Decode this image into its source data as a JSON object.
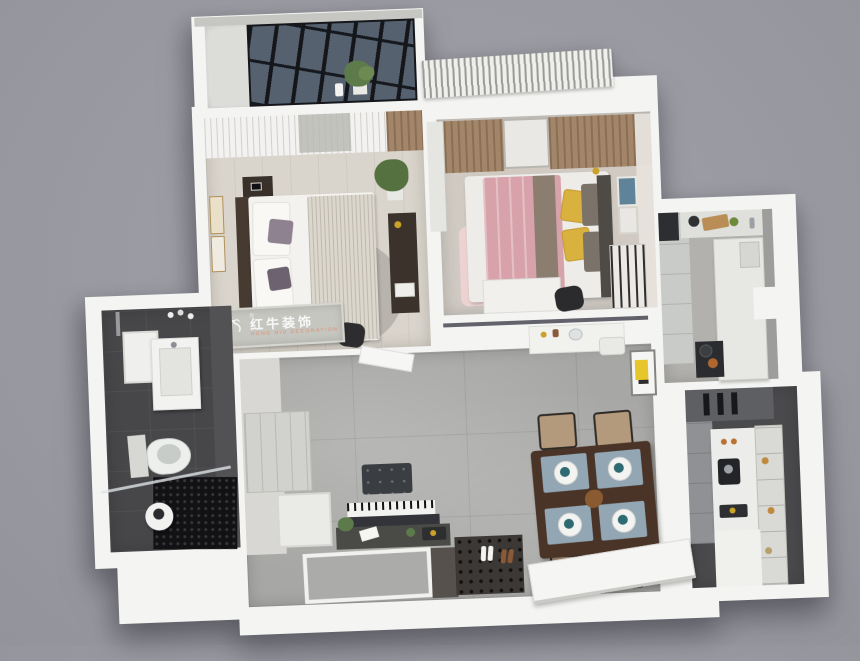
{
  "meta": {
    "description": "3D top-down isometric rendering of a two-bedroom apartment floor plan",
    "background_color": "#9a9aa2",
    "wall_color": "#f4f4f2"
  },
  "watermark": {
    "logo": "bull-icon",
    "registered": "®",
    "brand_cn": "红牛装饰",
    "brand_en": "HONG NIU DECORATION",
    "panel_color": "#c6c6c0",
    "cn_text_color": "#ffffff",
    "en_text_color": "#e9805c"
  },
  "palette": {
    "living_floor_marble": "#a7a7a5",
    "bedroom1_floor": "#dad5cc",
    "bedroom2_floor": "#d0cac3",
    "bathroom_tile": "#47474a",
    "shower_mosaic": "#121214",
    "kitchen_floor": "#b3b1ad",
    "glass_window": "#566170",
    "pink_duvet": "#d8a2aa",
    "yellow_pillow": "#d9b13e",
    "accent_pillow": "#8e8290",
    "dark_wood": "#4a3427",
    "chair_seat": "#b49a7d",
    "placemat": "#92a6b4",
    "napkin_teal": "#2e6a72",
    "plant_green": "#5d7a4a",
    "gold": "#c9a227"
  },
  "rooms": [
    {
      "id": "balcony",
      "name": "balcony",
      "features": [
        "black-framed glass skylight windows",
        "wardrobe cabinet",
        "potted plant",
        "white vase"
      ]
    },
    {
      "id": "master-bedroom",
      "name": "master bedroom",
      "features": [
        "white double bed with ribbed blanket",
        "dark headboard",
        "sheer curtains",
        "nightstand with phone",
        "desk with books",
        "round rug",
        "potted plant",
        "two wall frames",
        "office chair",
        "watermark banner"
      ]
    },
    {
      "id": "second-bedroom",
      "name": "second bedroom",
      "features": [
        "pink double bed",
        "two yellow pillows",
        "gray pillows",
        "tan pleated curtains with window",
        "pink rug",
        "white desk",
        "black chair",
        "book ladder shelf",
        "two picture frames",
        "gold wall lamp",
        "sliding door",
        "striped curtain overhanging wall"
      ]
    },
    {
      "id": "kitchen",
      "name": "galley kitchen",
      "features": [
        "tall cabinet run",
        "white island counter",
        "sink with faucet",
        "cooktop with two pans",
        "cutting board with greens"
      ]
    },
    {
      "id": "pantry",
      "name": "pantry / tea room",
      "features": [
        "dark appliance cabinet",
        "gray cabinet run",
        "coffee counter with coffee machine",
        "glass display shelf with amber glassware",
        "white base cabinet"
      ]
    },
    {
      "id": "living-dining",
      "name": "living / dining room",
      "features": [
        "gray marble tile floor",
        "dark wood dining table",
        "four tan chairs",
        "four blue placemats with white plates and teal napkins",
        "center table decor",
        "digital piano",
        "tufted piano bench",
        "dark console with plant and trays",
        "hallway closet",
        "white appliance box",
        "open interior door",
        "vanity console with stool",
        "yellow wall artwork",
        "entry mat with shoes",
        "open front door",
        "gray entry panel"
      ]
    },
    {
      "id": "bathroom",
      "name": "bathroom",
      "features": [
        "charcoal tile floor",
        "mirror",
        "white vanity sink",
        "toilet",
        "black mosaic shower floor",
        "round white stool with kettle",
        "glass partition",
        "shower pipe",
        "toiletry bottles"
      ]
    }
  ]
}
